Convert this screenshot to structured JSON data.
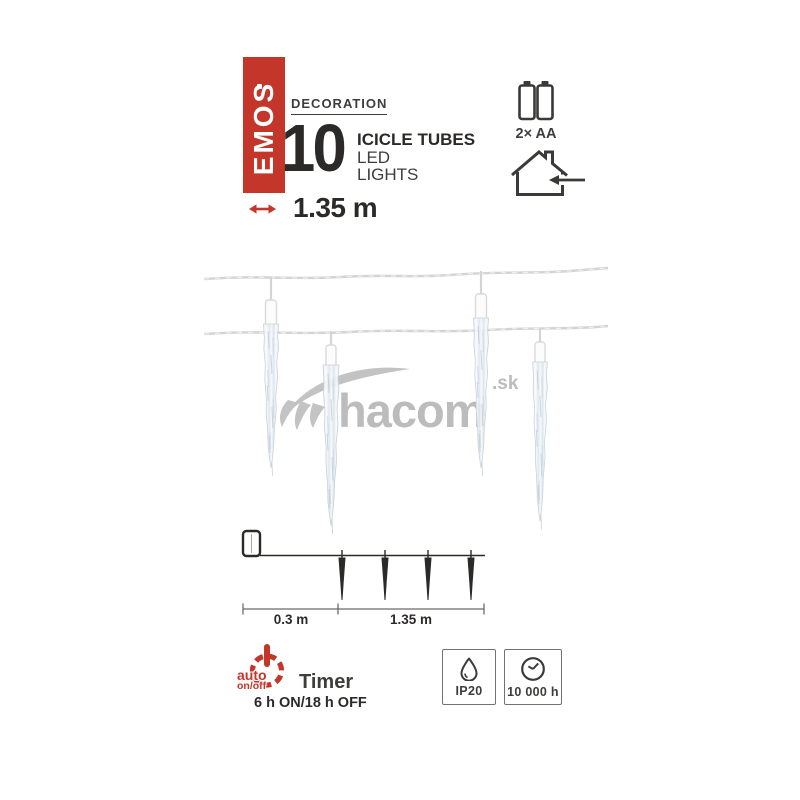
{
  "brand": {
    "name": "EMOS"
  },
  "header": {
    "category": "DECORATION",
    "quantity": "10",
    "title": "ICICLE TUBES",
    "subtitle_line1": "LED",
    "subtitle_line2": "LIGHTS",
    "length": "1.35 m",
    "battery": "2× AA"
  },
  "watermark": {
    "name": "hacom",
    "tld": ".sk"
  },
  "diagram": {
    "lead_length": "0.3 m",
    "lit_length": "1.35 m"
  },
  "features": {
    "timer": {
      "auto": "auto",
      "mode": "on/off",
      "label": "Timer",
      "schedule": "6 h ON/18 h OFF"
    },
    "ip_rating": "IP20",
    "lifetime": "10 000 h"
  },
  "icons": {
    "battery": "aa-batteries-icon",
    "indoor": "house-arrow-in-icon",
    "length": "double-arrow-icon",
    "timer": "power-auto-icon",
    "ip": "water-drop-icon",
    "lifetime": "clock-icon"
  },
  "colors": {
    "brand_red": "#c4352a",
    "text_dark": "#2b2a29",
    "text_gray": "#3d3d3c",
    "icon_dark": "#3a3a38",
    "watermark_gray": "#bcbcbc"
  }
}
